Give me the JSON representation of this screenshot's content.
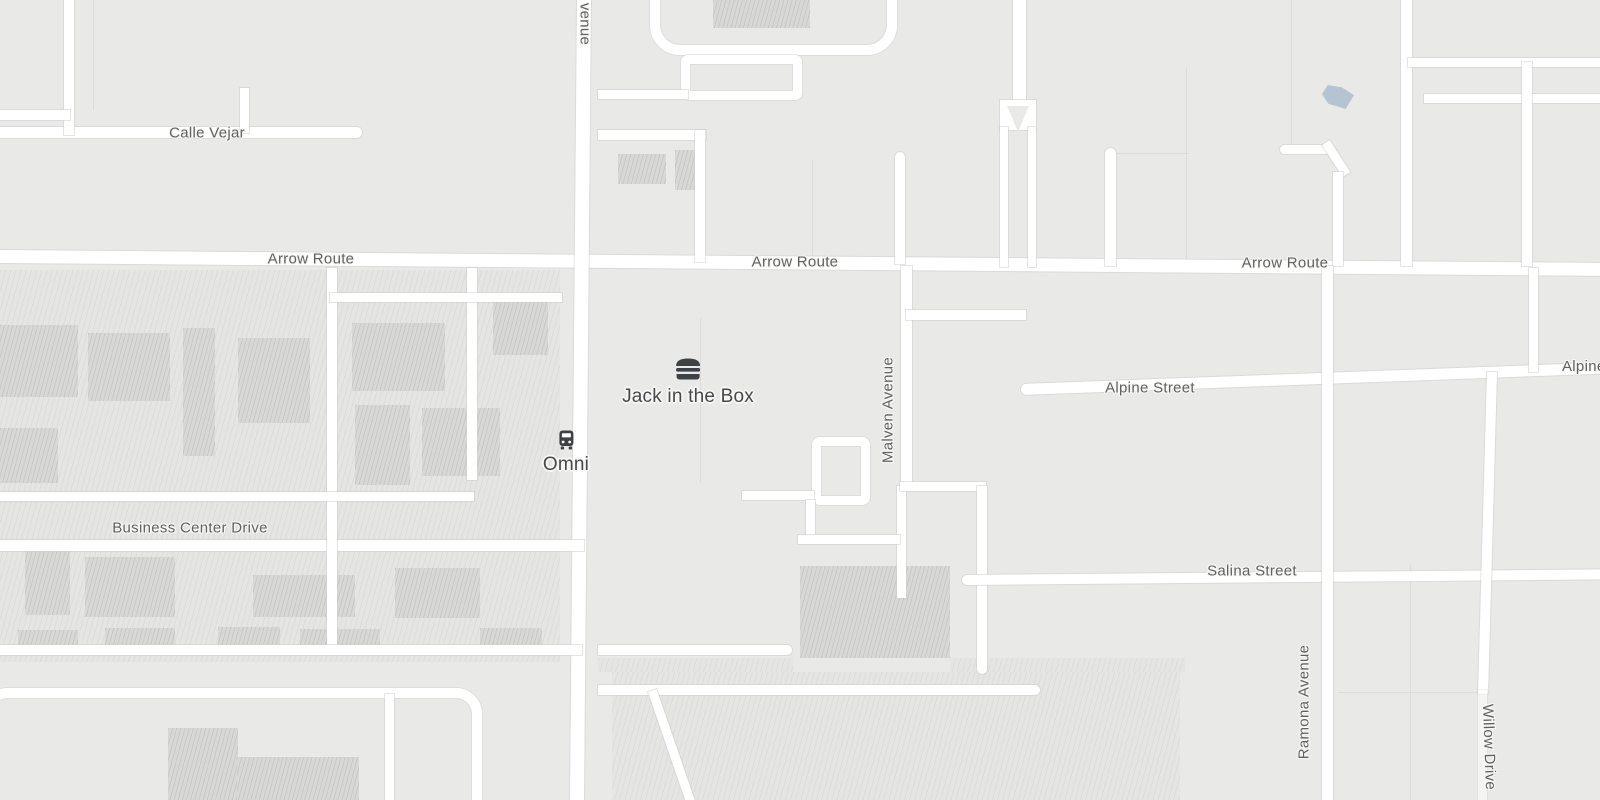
{
  "map": {
    "streets": {
      "arrow_route": "Arrow Route",
      "calle_vejar": "Calle Vejar",
      "business_center_drive": "Business Center Drive",
      "alpine_street": "Alpine Street",
      "salina_street": "Salina Street",
      "malven_avenue": "Malven Avenue",
      "ramona_avenue": "Ramona Avenue",
      "willow_drive": "Willow Drive",
      "avenue_partial": "venue"
    },
    "pois": {
      "restaurant": {
        "name": "Jack in the Box",
        "icon": "burger-icon"
      },
      "transit": {
        "name": "Omni",
        "icon": "bus-icon"
      }
    },
    "colors": {
      "background": "#e9eae8",
      "road": "#ffffff",
      "area_hatch": "#e4e5e3",
      "building": "#d8d9d7",
      "water": "#b5c3d2",
      "street_label": "#616161",
      "poi_label": "#46484b"
    }
  }
}
